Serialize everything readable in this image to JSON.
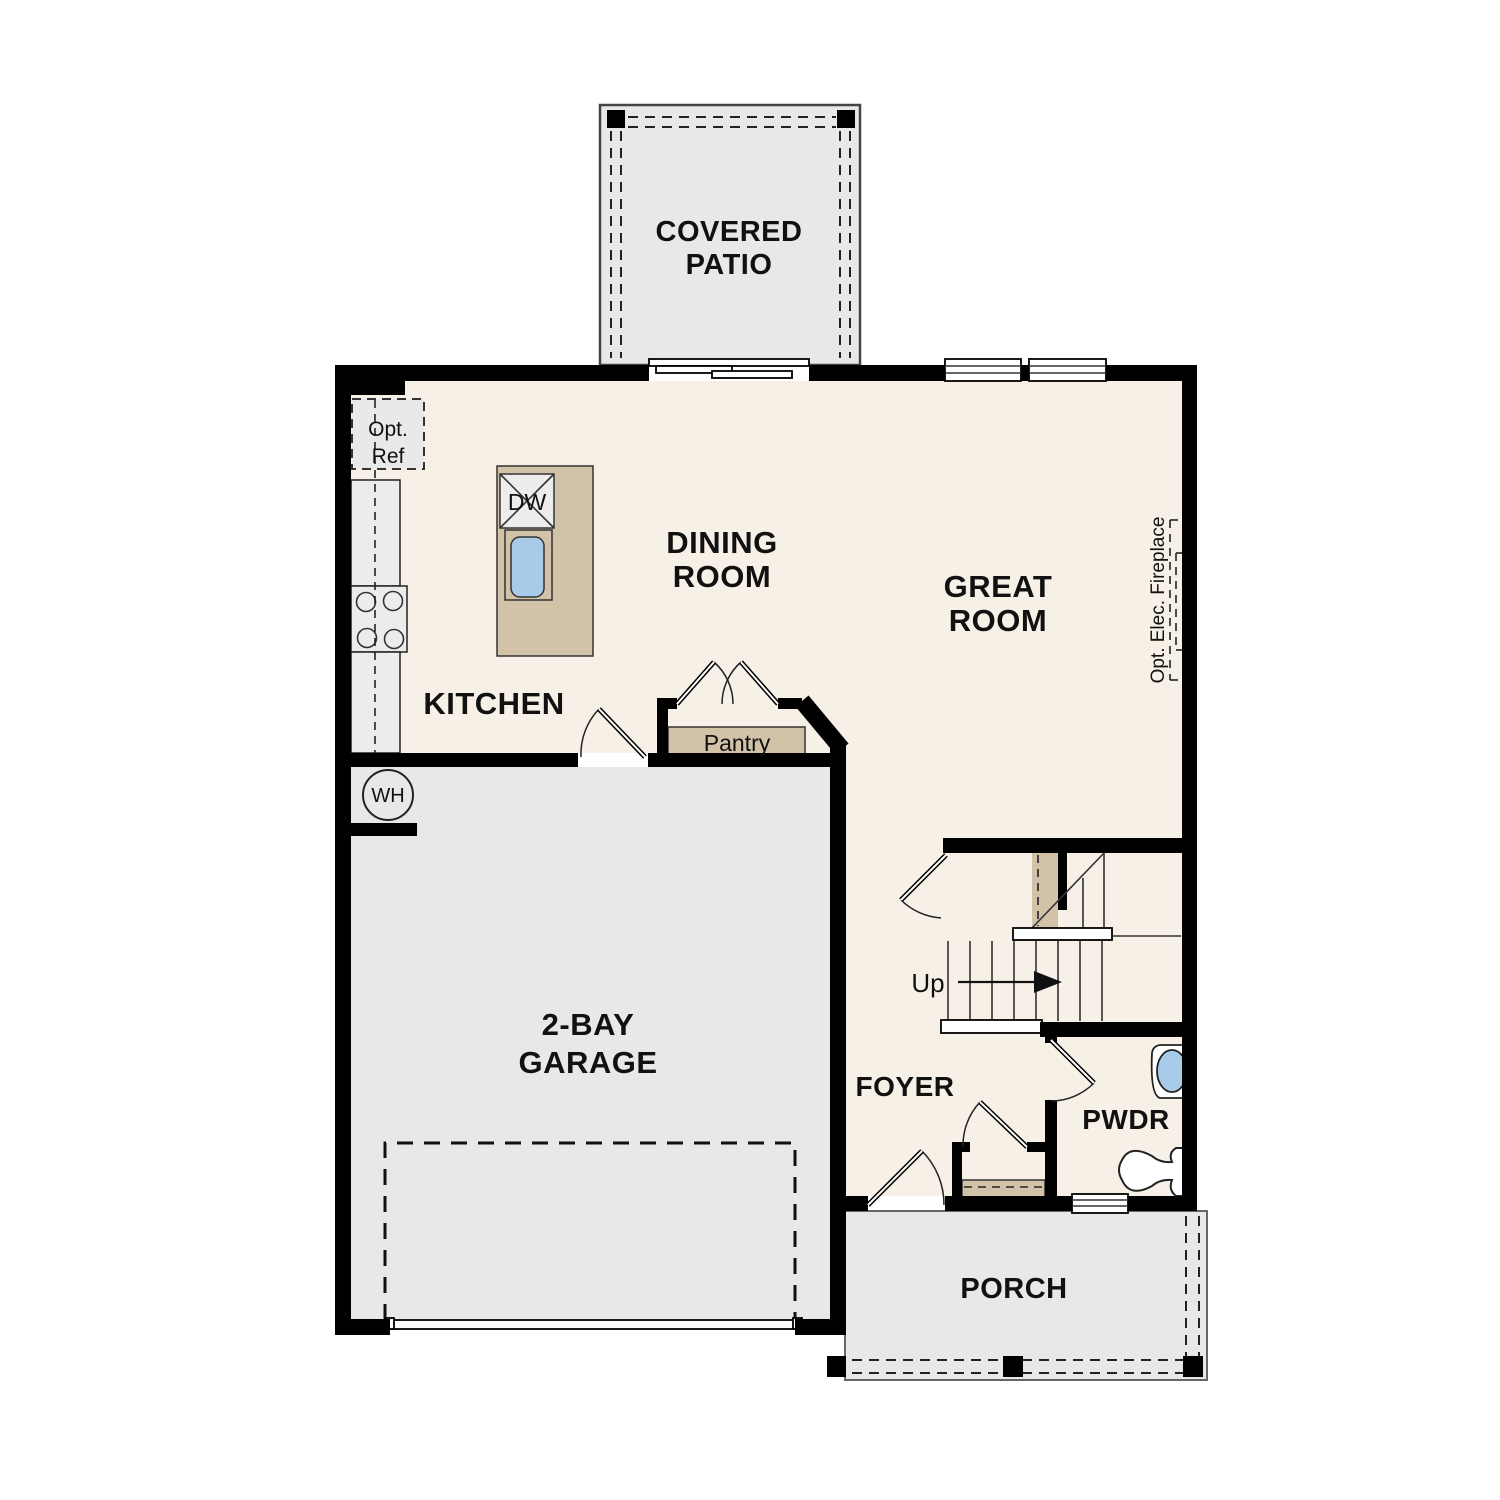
{
  "plan_title": "First floor residential floor plan",
  "rooms": {
    "covered_patio": {
      "lines": [
        "COVERED",
        "PATIO"
      ]
    },
    "dining_room": {
      "lines": [
        "DINING",
        "ROOM"
      ]
    },
    "great_room": {
      "lines": [
        "GREAT",
        "ROOM"
      ]
    },
    "kitchen": {
      "lines": [
        "KITCHEN"
      ]
    },
    "garage": {
      "lines": [
        "2-BAY",
        "GARAGE"
      ]
    },
    "foyer": {
      "lines": [
        "FOYER"
      ]
    },
    "powder_room": {
      "lines": [
        "PWDR"
      ]
    },
    "porch": {
      "lines": [
        "PORCH"
      ]
    }
  },
  "annotations": {
    "pantry": "Pantry",
    "optional_refrigerator": {
      "lines": [
        "Opt.",
        "Ref"
      ]
    },
    "optional_fireplace": "Opt. Elec. Fireplace",
    "water_heater": "WH",
    "dishwasher": "DW",
    "stairs_up": "Up"
  },
  "colors": {
    "wall": "#000000",
    "interior_floor": "#f7f0e6",
    "hardscape_gray": "#e8e8e6",
    "casework_tan": "#d2c3a8",
    "fixture_blue": "#a9cbea"
  }
}
